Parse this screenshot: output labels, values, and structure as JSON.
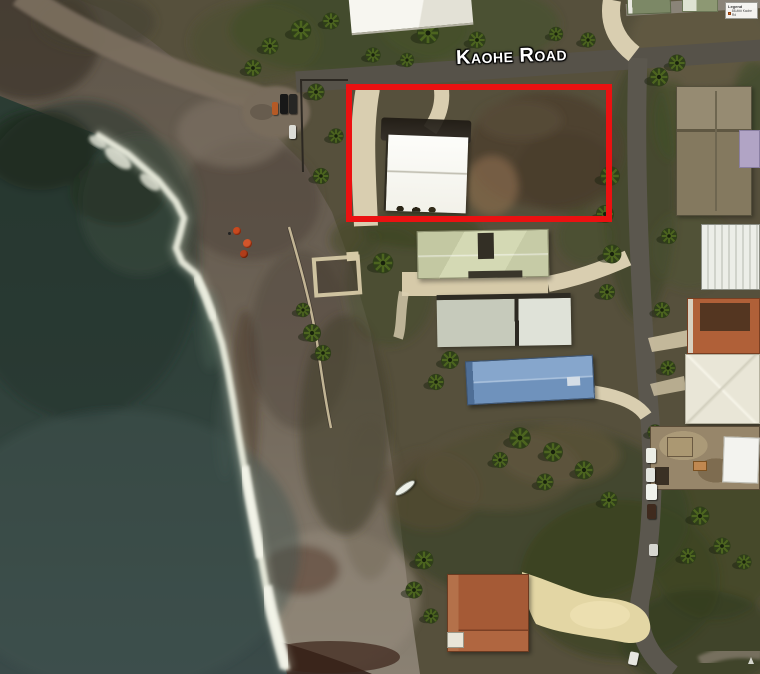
{
  "map": {
    "type": "satellite-aerial-photo",
    "road_label": "Kaohe Road",
    "legend": {
      "title": "Legend",
      "entry": "88-### Kaohe Rd"
    },
    "annotation": {
      "highlight_box_color": "#eb1111"
    },
    "colors": {
      "ocean": "#2e4038",
      "ocean_deep": "#22302a",
      "surf_foam": "#edefe0",
      "beach_sand": "#7c7264",
      "lava_rock": "#2e1c15",
      "land": "#56503c",
      "vegetation": "#3e4926",
      "asphalt_road": "#57534b",
      "concrete_driveway": "#d9ceb0"
    },
    "features": {
      "buildings": [
        {
          "name": "white-gable-building-in-highlight",
          "roof_color": "#fbfbf7"
        },
        {
          "name": "white-roof-building-north",
          "roof_color": "#f5f4ef"
        },
        {
          "name": "pale-green-hip-roof-house",
          "roof_color": "#cdd2ad"
        },
        {
          "name": "twin-gray-roof-house",
          "roof_color": "#cfd3c8"
        },
        {
          "name": "blue-metal-roof-building",
          "roof_color": "#7d9cc4"
        },
        {
          "name": "terracotta-roof-house-south",
          "roof_color": "#a55a36"
        },
        {
          "name": "brown-roof-house-northeast",
          "roof_color": "#887d64"
        },
        {
          "name": "lavender-roof-house-east",
          "roof_color": "#b1a4c5"
        },
        {
          "name": "white-carport-east",
          "roof_color": "#e5e7e1"
        },
        {
          "name": "terracotta-roof-house-east",
          "roof_color": "#b06038"
        },
        {
          "name": "cream-hip-roof-house-east",
          "roof_color": "#e9e6d8"
        },
        {
          "name": "construction-site-white-roof",
          "roof_color": "#f3f3ef"
        },
        {
          "name": "green-roof-sheds-north",
          "roof_color": "#7c8866"
        }
      ],
      "objects": [
        "parked-cars",
        "beach-umbrellas",
        "small-boat-on-sand",
        "palm-trees",
        "ruin-walls"
      ]
    }
  }
}
